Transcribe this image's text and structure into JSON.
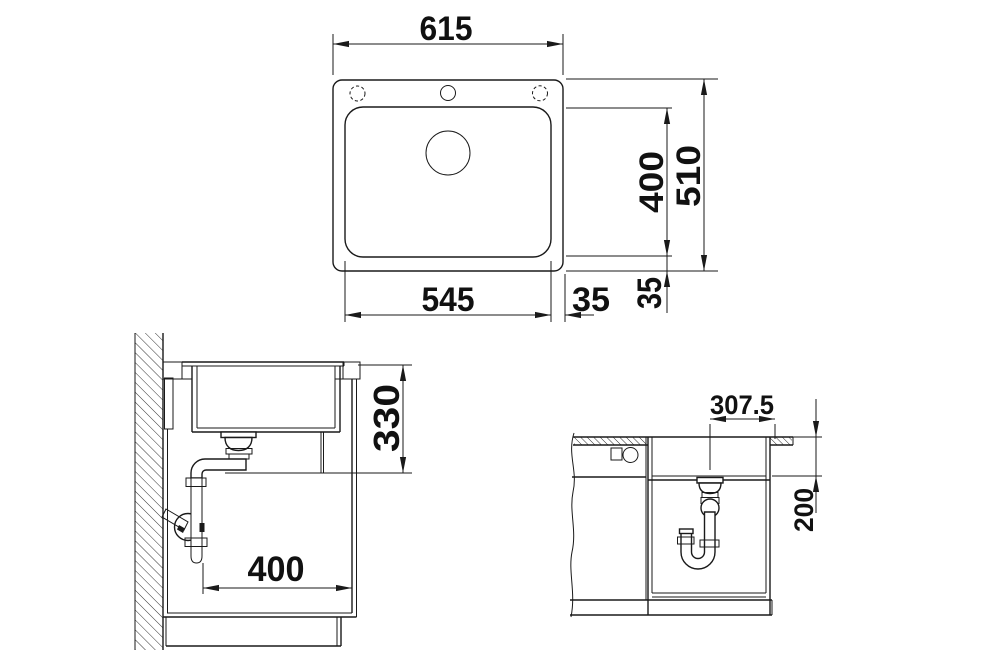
{
  "page": {
    "background": "#ffffff",
    "title": "sink installation dimension drawing"
  },
  "drawing": {
    "line_color": "#1a1a1a",
    "top_view": {
      "label": "sink top view",
      "dims": {
        "overall_width": "615",
        "basin_width": "545",
        "basin_right_offset": "35",
        "basin_bottom_offset": "35",
        "basin_depth": "400",
        "overall_depth": "510"
      }
    },
    "side_view": {
      "label": "cabinet side section",
      "dims": {
        "outlet_height": "330",
        "min_cabinet_depth": "400"
      }
    },
    "front_view": {
      "label": "cabinet front section",
      "dims": {
        "drain_center_offset": "307.5",
        "bowl_depth": "200"
      }
    }
  }
}
